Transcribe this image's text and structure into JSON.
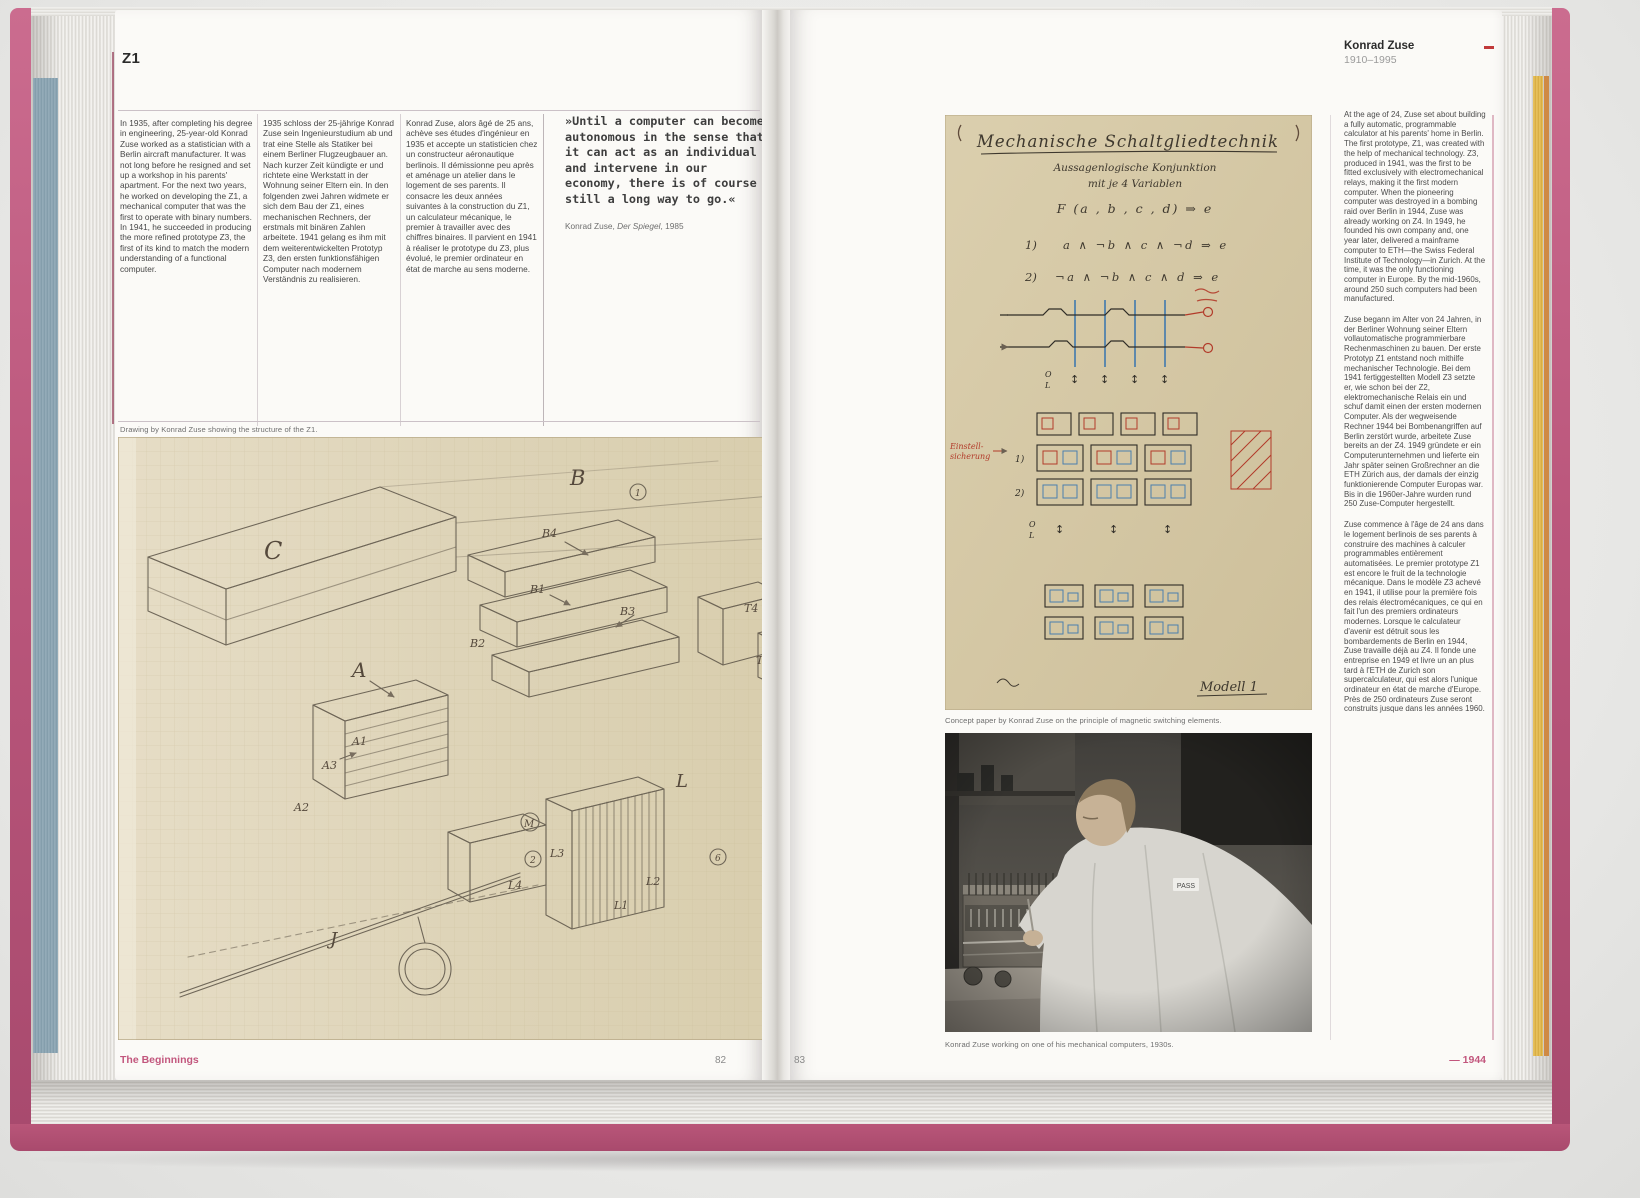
{
  "left_page": {
    "heading": "Z1",
    "col_en": "In 1935, after completing his degree in engineering, 25-year-old Konrad Zuse worked as a statistician with a Berlin aircraft manufacturer. It was not long before he resigned and set up a workshop in his parents' apartment. For the next two years, he worked on developing the Z1, a mechanical computer that was the first to operate with binary numbers. In 1941, he succeeded in producing the more refined prototype Z3, the first of its kind to match the modern understanding of a functional computer.",
    "col_de": "1935 schloss der 25-jährige Konrad Zuse sein Ingenieurstudium ab und trat eine Stelle als Statiker bei einem Berliner Flugzeugbauer an. Nach kurzer Zeit kündigte er und richtete eine Werkstatt in der Wohnung seiner Eltern ein. In den folgenden zwei Jahren widmete er sich dem Bau der Z1, eines mechanischen Rechners, der erstmals mit binären Zahlen arbeitete. 1941 gelang es ihm mit dem weiterentwickelten Prototyp Z3, den ersten funktionsfähigen Computer nach modernem Verständnis zu realisieren.",
    "col_fr": "Konrad Zuse, alors âgé de 25 ans, achève ses études d'ingénieur en 1935 et accepte un statisticien chez un constructeur aéronautique berlinois. Il démissionne peu après et aménage un atelier dans le logement de ses parents. Il consacre les deux années suivantes à la construction du Z1, un calculateur mécanique, le premier à travailler avec des chiffres binaires. Il parvient en 1941 à réaliser le prototype du Z3, plus évolué, le premier ordinateur en état de marche au sens moderne.",
    "quote": {
      "text": "»Until a computer can become autonomous in the sense that it can act as an individual and intervene in our economy, there is of course still a long way to go.«",
      "attr_name": "Konrad Zuse, ",
      "attr_source": "Der Spiegel",
      "attr_year": ", 1985"
    },
    "drawing_caption": "Drawing by Konrad Zuse showing the structure of the Z1.",
    "drawing": {
      "labels": {
        "c": "C",
        "b": "B",
        "b1": "B1",
        "b2": "B2",
        "b3": "B3",
        "b4": "B4",
        "a": "A",
        "a1": "A1",
        "a2": "A2",
        "a3": "A3",
        "t": "T",
        "t1": "T1",
        "t2": "T2",
        "t3": "T3",
        "t4": "T4",
        "l": "L",
        "l1": "L1",
        "l2": "L2",
        "l3": "L3",
        "l4": "L4",
        "j": "J",
        "m": "M",
        "z1": "Z1",
        "n1": "1",
        "n2": "2",
        "n4": "4",
        "n6": "6"
      }
    },
    "footer_section": "The Beginnings",
    "page_number": "82"
  },
  "right_page": {
    "header_name": "Konrad Zuse",
    "header_dates": "1910–1995",
    "concept": {
      "title": "Mechanische Schaltgliedtechnik",
      "subtitle1": "Aussagenlogische Konjunktion",
      "subtitle2": "mit je 4 Variablen",
      "formula": "F (a , b , c , d) ⇒ e",
      "eq1_no": "1)",
      "eq1": "a ∧ ¬b ∧ c ∧ ¬d ⇒ e",
      "eq2_no": "2)",
      "eq2": "¬a ∧ ¬b ∧ c ∧ d ⇒ e",
      "row1_no": "1)",
      "row2_no": "2)",
      "side_label_line1": "Einstell-",
      "side_label_line2": "sicherung",
      "o_label": "O",
      "l_label": "L",
      "model_label": "Modell 1"
    },
    "concept_caption": "Concept paper by Konrad Zuse on the principle of magnetic switching elements.",
    "photo": {
      "badge": "PASS"
    },
    "photo_caption": "Konrad Zuse working on one of his mechanical computers, 1930s.",
    "sidebar": {
      "en": "At the age of 24, Zuse set about building a fully automatic, programmable calculator at his parents' home in Berlin. The first prototype, Z1, was created with the help of mechanical technology. Z3, produced in 1941, was the first to be fitted exclusively with electromechanical relays, making it the first modern computer. When the pioneering computer was destroyed in a bombing raid over Berlin in 1944, Zuse was already working on Z4. In 1949, he founded his own company and, one year later, delivered a mainframe computer to ETH—the Swiss Federal Institute of Technology—in Zurich. At the time, it was the only functioning computer in Europe. By the mid-1960s, around 250 such computers had been manufactured.",
      "de": "Zuse begann im Alter von 24 Jahren, in der Berliner Wohnung seiner Eltern vollautomatische programmierbare Rechenmaschinen zu bauen. Der erste Prototyp Z1 entstand noch mithilfe mechanischer Technologie. Bei dem 1941 fertiggestellten Modell Z3 setzte er, wie schon bei der Z2, elektromechanische Relais ein und schuf damit einen der ersten modernen Computer. Als der wegweisende Rechner 1944 bei Bombenangriffen auf Berlin zerstört wurde, arbeitete Zuse bereits an der Z4. 1949 gründete er ein Computerunternehmen und lieferte ein Jahr später seinen Großrechner an die ETH Zürich aus, der damals der einzig funktionierende Computer Europas war. Bis in die 1960er-Jahre wurden rund 250 Zuse-Computer hergestellt.",
      "fr": "Zuse commence à l'âge de 24 ans dans le logement berlinois de ses parents à construire des machines à calculer programmables entièrement automatisées. Le premier prototype Z1 est encore le fruit de la technologie mécanique. Dans le modèle Z3 achevé en 1941, il utilise pour la première fois des relais électromécaniques, ce qui en fait l'un des premiers ordinateurs modernes. Lorsque le calculateur d'avenir est détruit sous les bombardements de Berlin en 1944, Zuse travaille déjà au Z4. Il fonde une entreprise en 1949 et livre un an plus tard à l'ETH de Zurich son supercalculateur, qui est alors l'unique ordinateur en état de marche d'Europe. Près de 250 ordinateurs Zuse seront construits jusque dans les années 1960."
    },
    "page_number": "83",
    "footer_year": "— 1944"
  },
  "colors": {
    "accent_pink": "#c2567d",
    "cover_pink": "#bb577c",
    "edge_blue": "#8ba4b2",
    "edge_yellow": "#ddb34c",
    "paper_tan": "#dcd2b4",
    "rule_gray": "#cbc1c7",
    "schematic_red": "#b23b2a",
    "schematic_blue": "#4a7fae"
  }
}
